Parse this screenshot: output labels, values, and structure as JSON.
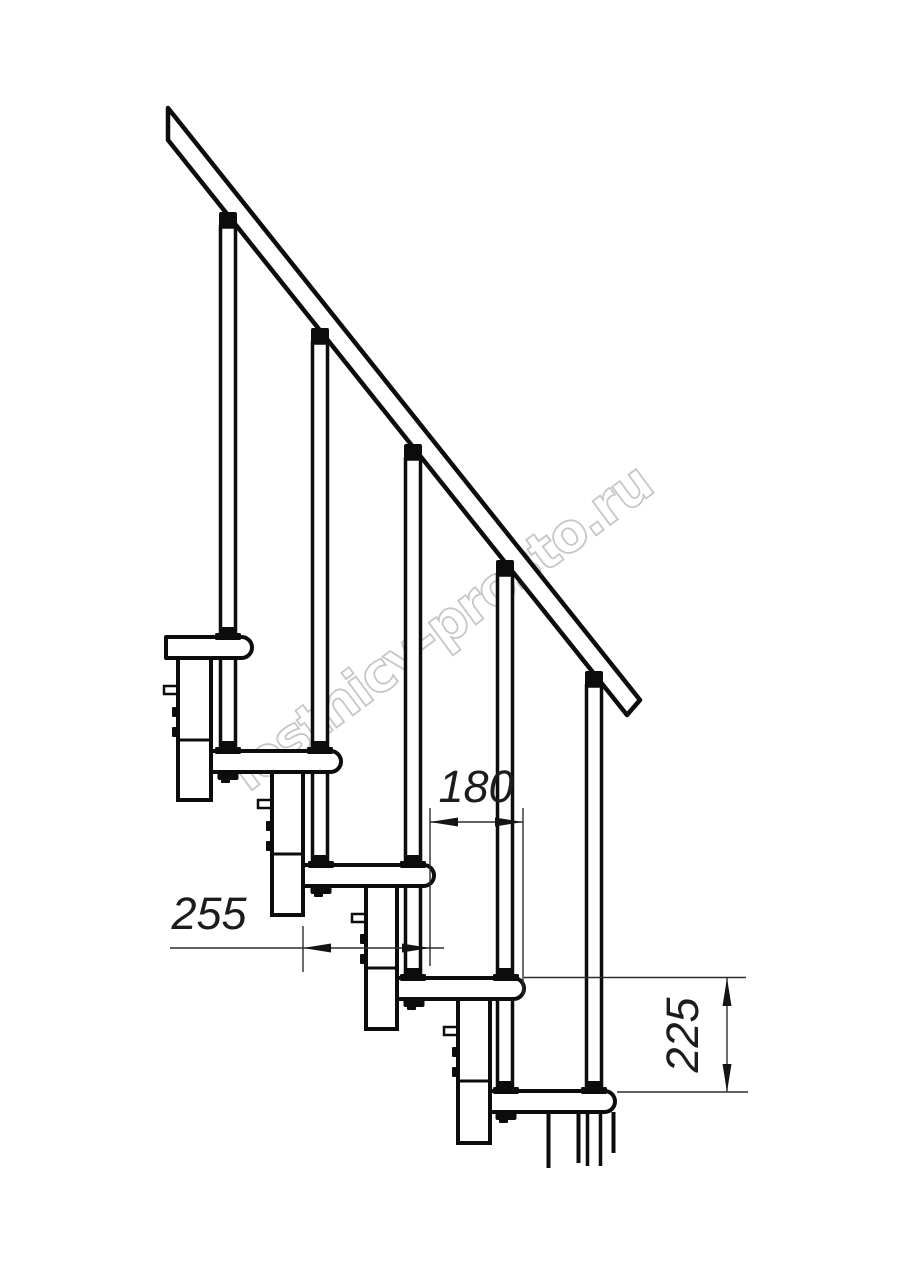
{
  "drawing": {
    "title": "Modular staircase side-view technical drawing",
    "watermark": "lestnicy-prosto.ru",
    "dimensions": {
      "step_run": "180",
      "tread_depth": "255",
      "step_rise": "225"
    },
    "elements": {
      "handrail": "inclined handrail with perpendicular end cut",
      "balusters_count": 5,
      "treads_count": 5,
      "modules_count": 5
    },
    "colors": {
      "outline": "#0c0c0c",
      "thin_line": "#2e2e2e",
      "fill": "#ffffff",
      "watermark": "#c7c7c7",
      "background": "#ffffff"
    }
  }
}
